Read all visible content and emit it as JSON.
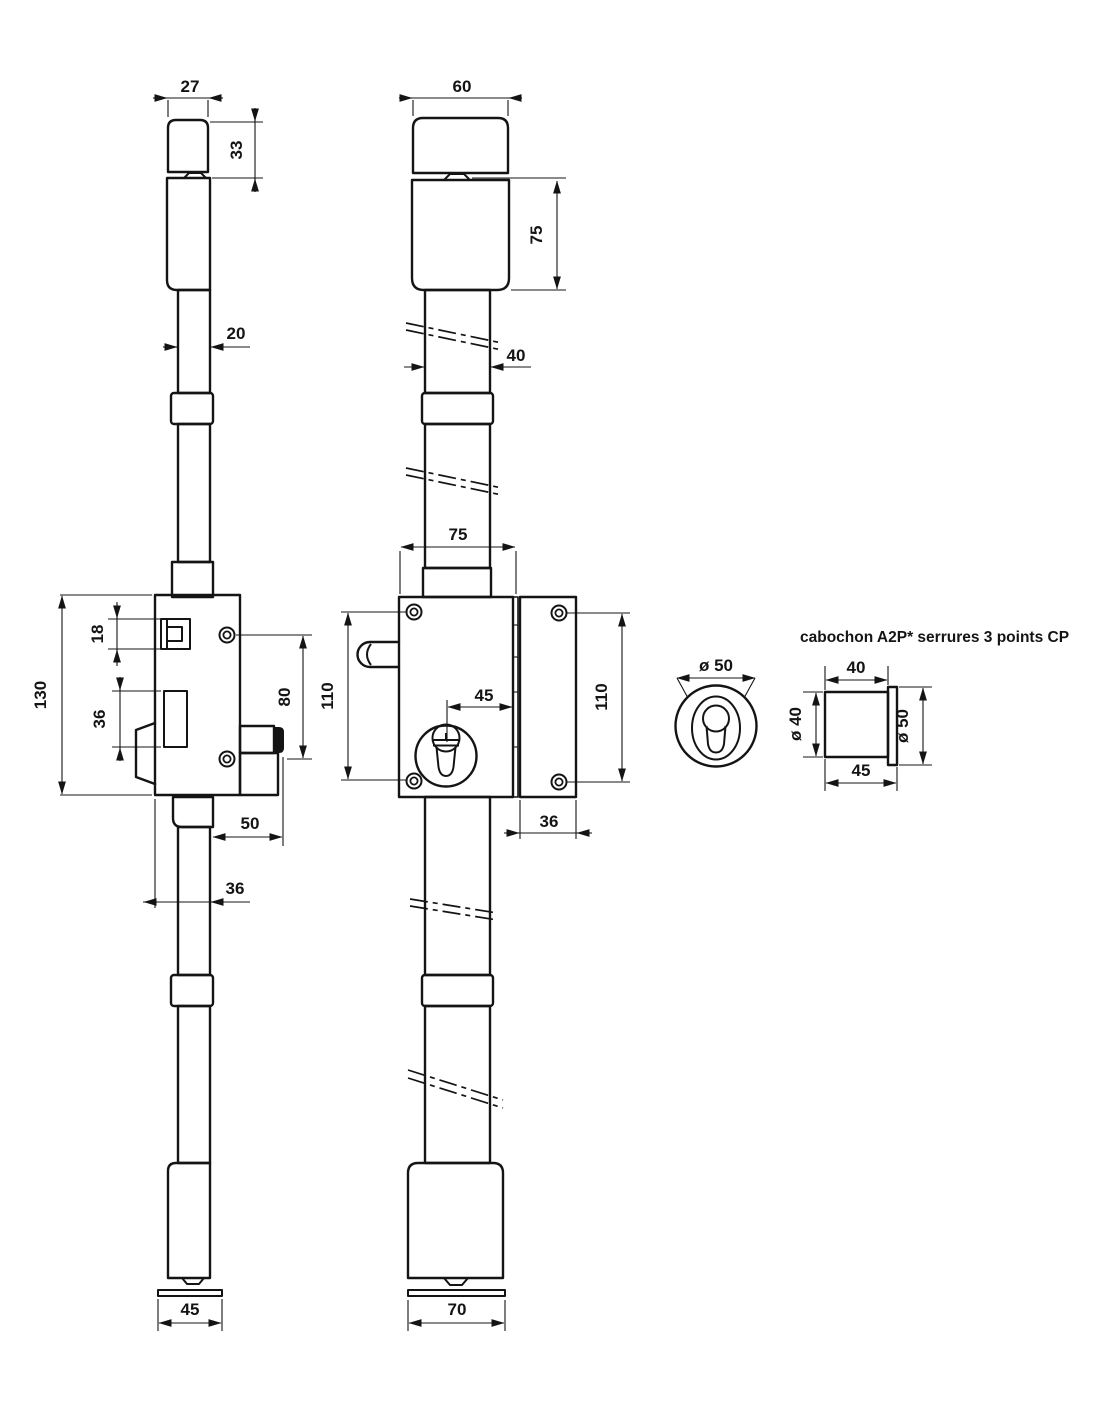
{
  "title": "cabochon A2P* serrures 3 points CP",
  "colors": {
    "line": "#141414",
    "background": "#ffffff"
  },
  "dims": {
    "side": {
      "cap_width": "27",
      "cap_height": "33",
      "rod_width": "20",
      "case_height": "130",
      "latch_height": "18",
      "follower_height": "36",
      "screw_spacing": "80",
      "bolt_throw": "50",
      "rod_to_case_edge": "36",
      "floor_plate": "45"
    },
    "front": {
      "cap_width": "60",
      "upper_body_height": "75",
      "rod_width": "40",
      "case_width": "75",
      "case_screw_spacing": "110",
      "cylinder_to_edge": "45",
      "strike_screw_spacing": "110",
      "strike_width": "36",
      "floor_plate": "70"
    },
    "cabochon": {
      "face_diameter": "ø 50",
      "body_width": "40",
      "body_diameter": "ø 40",
      "flange_diameter": "ø 50",
      "depth_total": "45"
    }
  }
}
